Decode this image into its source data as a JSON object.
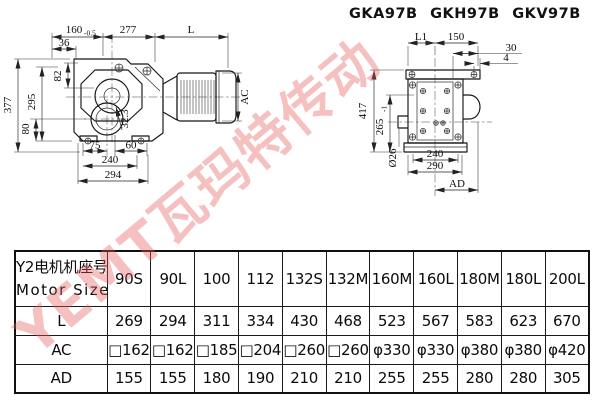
{
  "title": "GKA97B GKH97B GKV97B",
  "watermark": "YEMT瓦玛特传动",
  "drawing_left": {
    "dim_160": "160",
    "dim_160_tol": "-0.5",
    "dim_277": "277",
    "dim_L": "L",
    "dim_36": "36",
    "dim_82": "82",
    "dim_295": "295",
    "dim_377": "377",
    "dim_80": "80",
    "dim_75": "75",
    "dim_60": "60",
    "dim_240": "240",
    "dim_294": "294",
    "dim_323": "32.3",
    "dim_AC": "AC"
  },
  "drawing_right": {
    "dim_L1": "L1",
    "dim_150": "150",
    "dim_30": "30",
    "dim_4": "4",
    "dim_417": "417",
    "dim_265": "265",
    "dim_265_tol": "-1",
    "dim_26": "Ø26",
    "dim_240": "240",
    "dim_290": "290",
    "dim_AD": "AD"
  },
  "table": {
    "header_cn": "Y2电机机座号",
    "header_en": "Motor Size",
    "columns": [
      "90S",
      "90L",
      "100",
      "112",
      "132S",
      "132M",
      "160M",
      "160L",
      "180M",
      "180L",
      "200L"
    ],
    "rows": [
      {
        "label": "L",
        "values": [
          "269",
          "294",
          "311",
          "334",
          "430",
          "468",
          "523",
          "567",
          "583",
          "623",
          "670"
        ]
      },
      {
        "label": "AC",
        "values": [
          "□162",
          "□162",
          "□185",
          "□204",
          "□260",
          "□260",
          "φ330",
          "φ330",
          "φ380",
          "φ380",
          "φ420"
        ]
      },
      {
        "label": "AD",
        "values": [
          "155",
          "155",
          "180",
          "190",
          "210",
          "210",
          "255",
          "255",
          "280",
          "280",
          "305"
        ]
      }
    ]
  }
}
